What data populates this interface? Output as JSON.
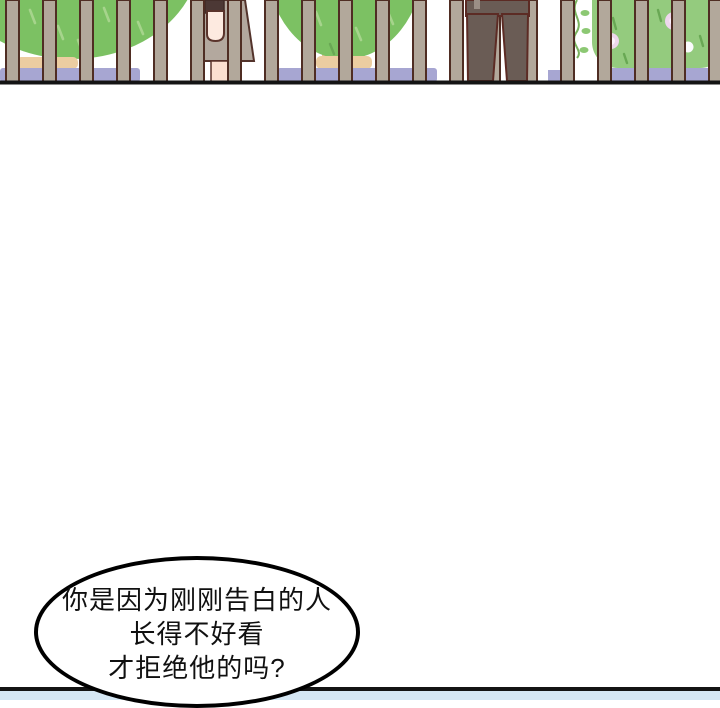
{
  "page": {
    "speech_bubble": {
      "lines": [
        "你是因为刚刚告白的人",
        "长得不好看",
        "才拒绝他的吗?"
      ]
    },
    "fence": {
      "bar_count": 20
    },
    "colors": {
      "tree_green": "#7cc163",
      "bush_green": "#94cb7e",
      "vine_leaf_green": "#8cc873",
      "ground_tan": "#eccda1",
      "trunk_tan": "#e3bf92",
      "ground_purple": "#a7a6d2",
      "fence_bar": "#b2a89b",
      "fence_outline": "#4f2d23",
      "baseline_black": "#141414",
      "water_blue": "#d5e7f4",
      "skin": "#fdeae0",
      "leg_skin": "#fbdfd0",
      "skirt_gray": "#b3a89e",
      "hair_brown": "#4c3835",
      "coat_brown": "#6a5c55",
      "flower_pink": "#eed7ec",
      "flower_center": "#fcf4fb",
      "bubble_outline": "#000000"
    }
  }
}
